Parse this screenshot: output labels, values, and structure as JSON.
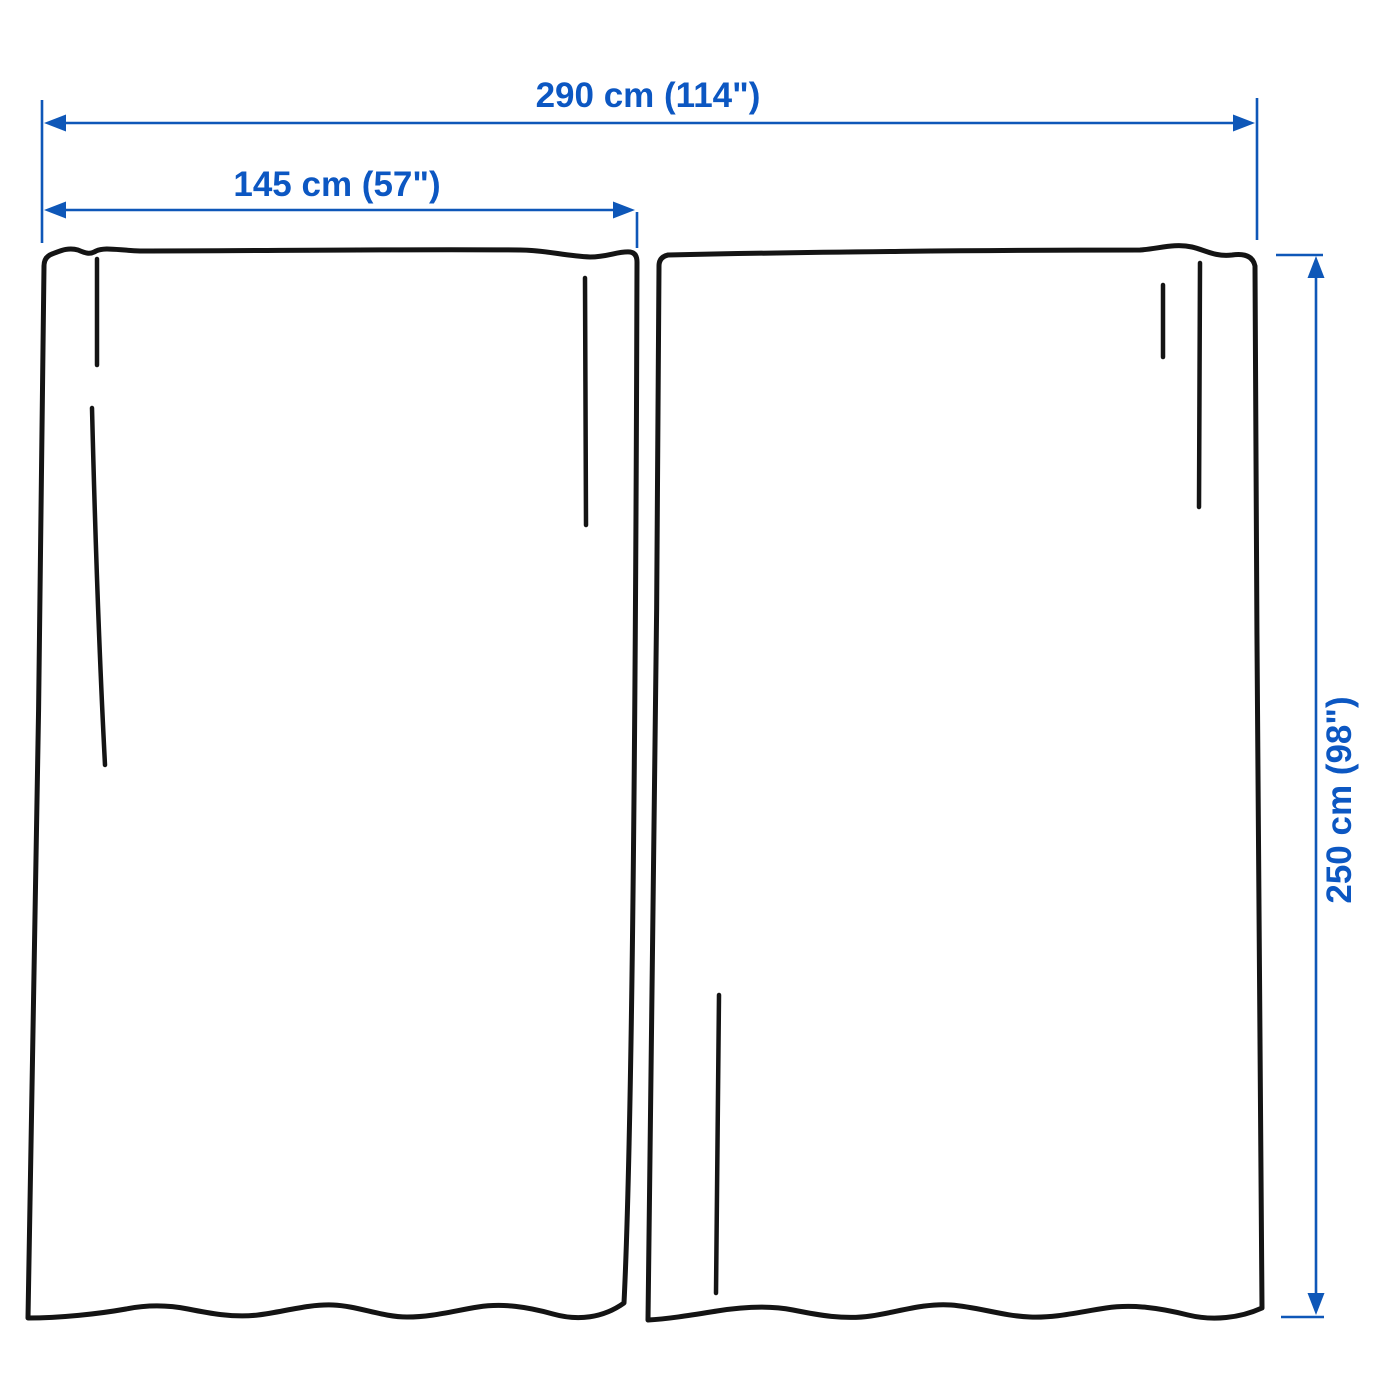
{
  "diagram": {
    "type": "product-dimension-illustration",
    "subject": "curtain-pair"
  },
  "dimensions": {
    "total_width": {
      "label": "290 cm (114\")",
      "value_cm": 290,
      "value_in": 114
    },
    "panel_width": {
      "label": "145 cm (57\")",
      "value_cm": 145,
      "value_in": 57
    },
    "panel_height": {
      "label": "250 cm (98\")",
      "value_cm": 250,
      "value_in": 98
    }
  },
  "colors": {
    "dimension_blue": "#0e57b8",
    "dimension_text_blue": "#0c57c2",
    "outline_black": "#141414",
    "background": "#ffffff"
  }
}
